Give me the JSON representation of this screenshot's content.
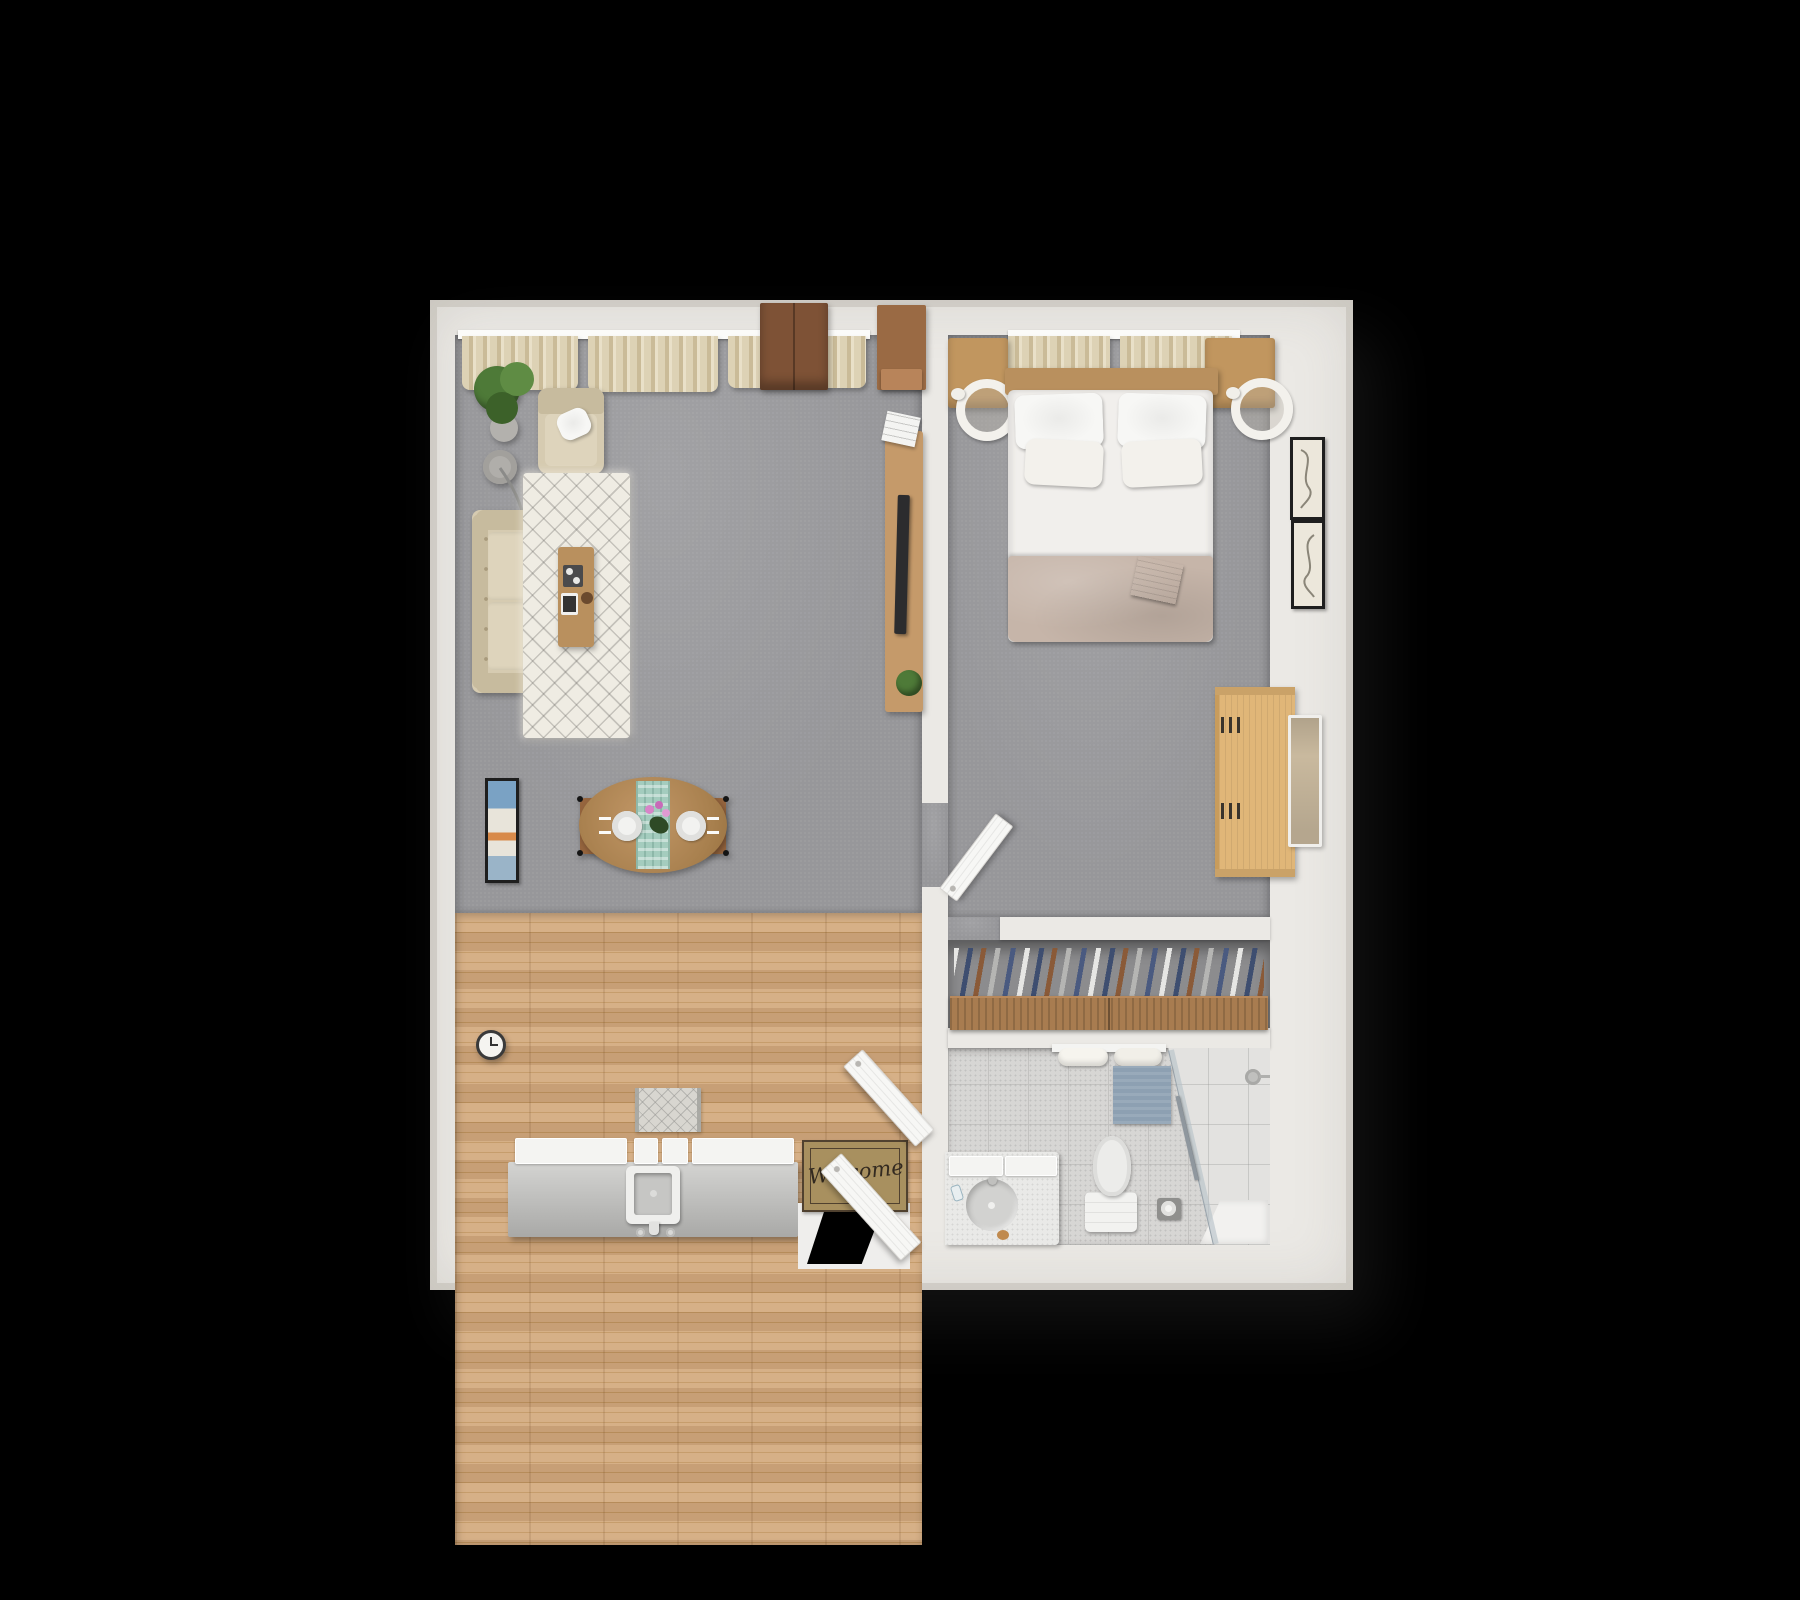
{
  "scene": {
    "type": "3d-floor-plan-top-view",
    "title": "One-bedroom apartment 3D floor plan",
    "welcome_mat_text": "Welcome",
    "colors": {
      "wall": "#ebe9e5",
      "carpet": "#97979a",
      "wood": "#d3a97d",
      "wood-dark": "#c1955f",
      "tile": "#d7d6d4",
      "tile-line": "#c3c2c0",
      "tile-light": "#e3e2e0",
      "sofa": "#d6cbb1",
      "sofa-dark": "#c7bb9e",
      "cushion": "#ded4bc",
      "curtain": "#ddd2b5",
      "curtain-dark": "#cabb98",
      "rug": "#efece3",
      "table": "#b9905e",
      "oak": "#c1965f",
      "walnut": "#7e5236",
      "cabinet": "#9a6a44",
      "console": "#c59a6a",
      "dresser": "#e0b678",
      "dresser-dark": "#caa268",
      "runner": "#a4ccbe",
      "blanket": "#c6b5a9",
      "sheet": "#f1efec",
      "white": "#f5f5f3",
      "mat": "#a8905f",
      "mat-dark": "#50412f",
      "bathmat": "#8da0b2",
      "tv-dark": "#2c2c2e",
      "tan-tv": "#c9b99e",
      "plant": "#4e7a38",
      "plant-dark": "#3c6129",
      "rod": "#a87c50",
      "door": "#f7f7f5",
      "glass": "#b9c3c9",
      "navy": "#3e4e70",
      "cloth-brown": "#8a5a38",
      "cloth-gray": "#b5b5b3",
      "frame-black": "#1e1e1e",
      "pink": "#d884c8"
    },
    "rooms": {
      "living_room": {
        "label": "living-room",
        "items": [
          "curtains",
          "potted-plant",
          "armchair",
          "arc-floor-lamp",
          "sofa",
          "area-rug",
          "coffee-table",
          "wardrobe-cabinets",
          "media-console-with-tv",
          "wall-art",
          "wall-clock",
          "dining-table",
          "dining-chairs",
          "table-runner",
          "plates",
          "flowers"
        ]
      },
      "kitchen_entry": {
        "label": "kitchen-entry",
        "items": [
          "kitchen-counter",
          "sink",
          "kitchen-rug",
          "welcome-mat",
          "entry-doors",
          "entry-opening"
        ]
      },
      "bedroom": {
        "label": "bedroom",
        "items": [
          "curtains",
          "double-bed",
          "pillows",
          "book",
          "nightstands",
          "round-lamps",
          "dresser",
          "wall-tv",
          "picture-frames",
          "bedroom-door"
        ]
      },
      "closet": {
        "label": "closet",
        "items": [
          "clothes-rail",
          "hanging-clothes"
        ]
      },
      "bathroom": {
        "label": "bathroom",
        "items": [
          "vanity-with-sink",
          "toilet",
          "toilet-paper-holder",
          "bath-mat",
          "towel-rail",
          "shower",
          "glass-screen",
          "shower-head"
        ]
      }
    }
  }
}
